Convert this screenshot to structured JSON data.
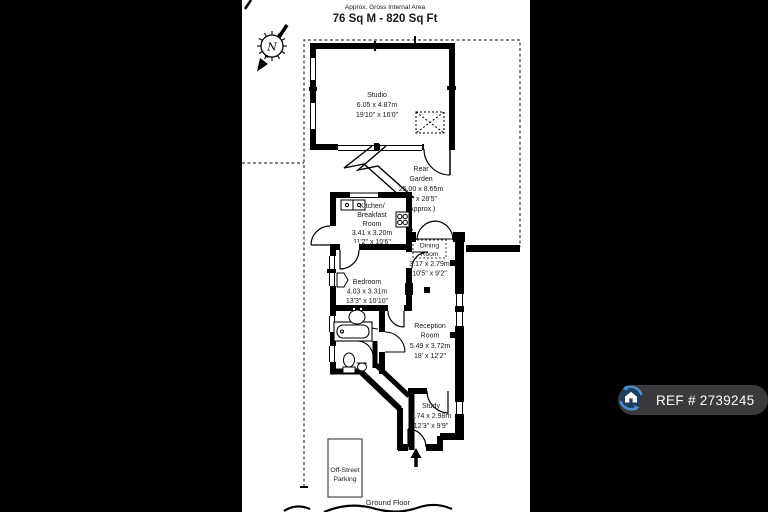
{
  "header": {
    "approx_label": "Approx. Gross Internal Area",
    "area": "76 Sq M - 820 Sq Ft"
  },
  "compass": {
    "north": "N"
  },
  "rooms": {
    "studio": {
      "name": "Studio",
      "metric": "6.05 x 4.87m",
      "imperial": "19'10\" x 16'0\""
    },
    "rear_garden": {
      "line1": "Rear",
      "line2": "Garden",
      "metric": "25.00 x 8.65m",
      "imperial": "82' x 28'5\"",
      "note": "(Approx.)"
    },
    "kitchen": {
      "line1": "Kitchen/",
      "line2": "Breakfast",
      "line3": "Room",
      "metric": "3.41 x 3.20m",
      "imperial": "11'2\" x 10'6\""
    },
    "dining": {
      "line1": "Dining",
      "line2": "Room",
      "metric": "3.17 x 2.79m",
      "imperial": "10'5\" x 9'2\""
    },
    "bedroom": {
      "name": "Bedroom",
      "metric": "4.03 x 3.31m",
      "imperial": "13'3\" x 10'10\""
    },
    "reception": {
      "line1": "Reception",
      "line2": "Room",
      "metric": "5.49 x 3.72m",
      "imperial": "18' x 12'2\""
    },
    "study": {
      "name": "Study",
      "metric": "3.74 x 2.98m",
      "imperial": "12'3\" x 9'9\""
    },
    "parking": {
      "line1": "Off-Street",
      "line2": "Parking"
    }
  },
  "footer": {
    "floor": "Ground Floor"
  },
  "badge": {
    "ref": "REF # 2739245"
  },
  "colors": {
    "page_bg": "#000000",
    "paper": "#ffffff",
    "plan_ink": "#000000",
    "badge_bg": "#3a3a3c",
    "logo_blue": "#4a90d2",
    "logo_navy": "#1c3f63"
  }
}
